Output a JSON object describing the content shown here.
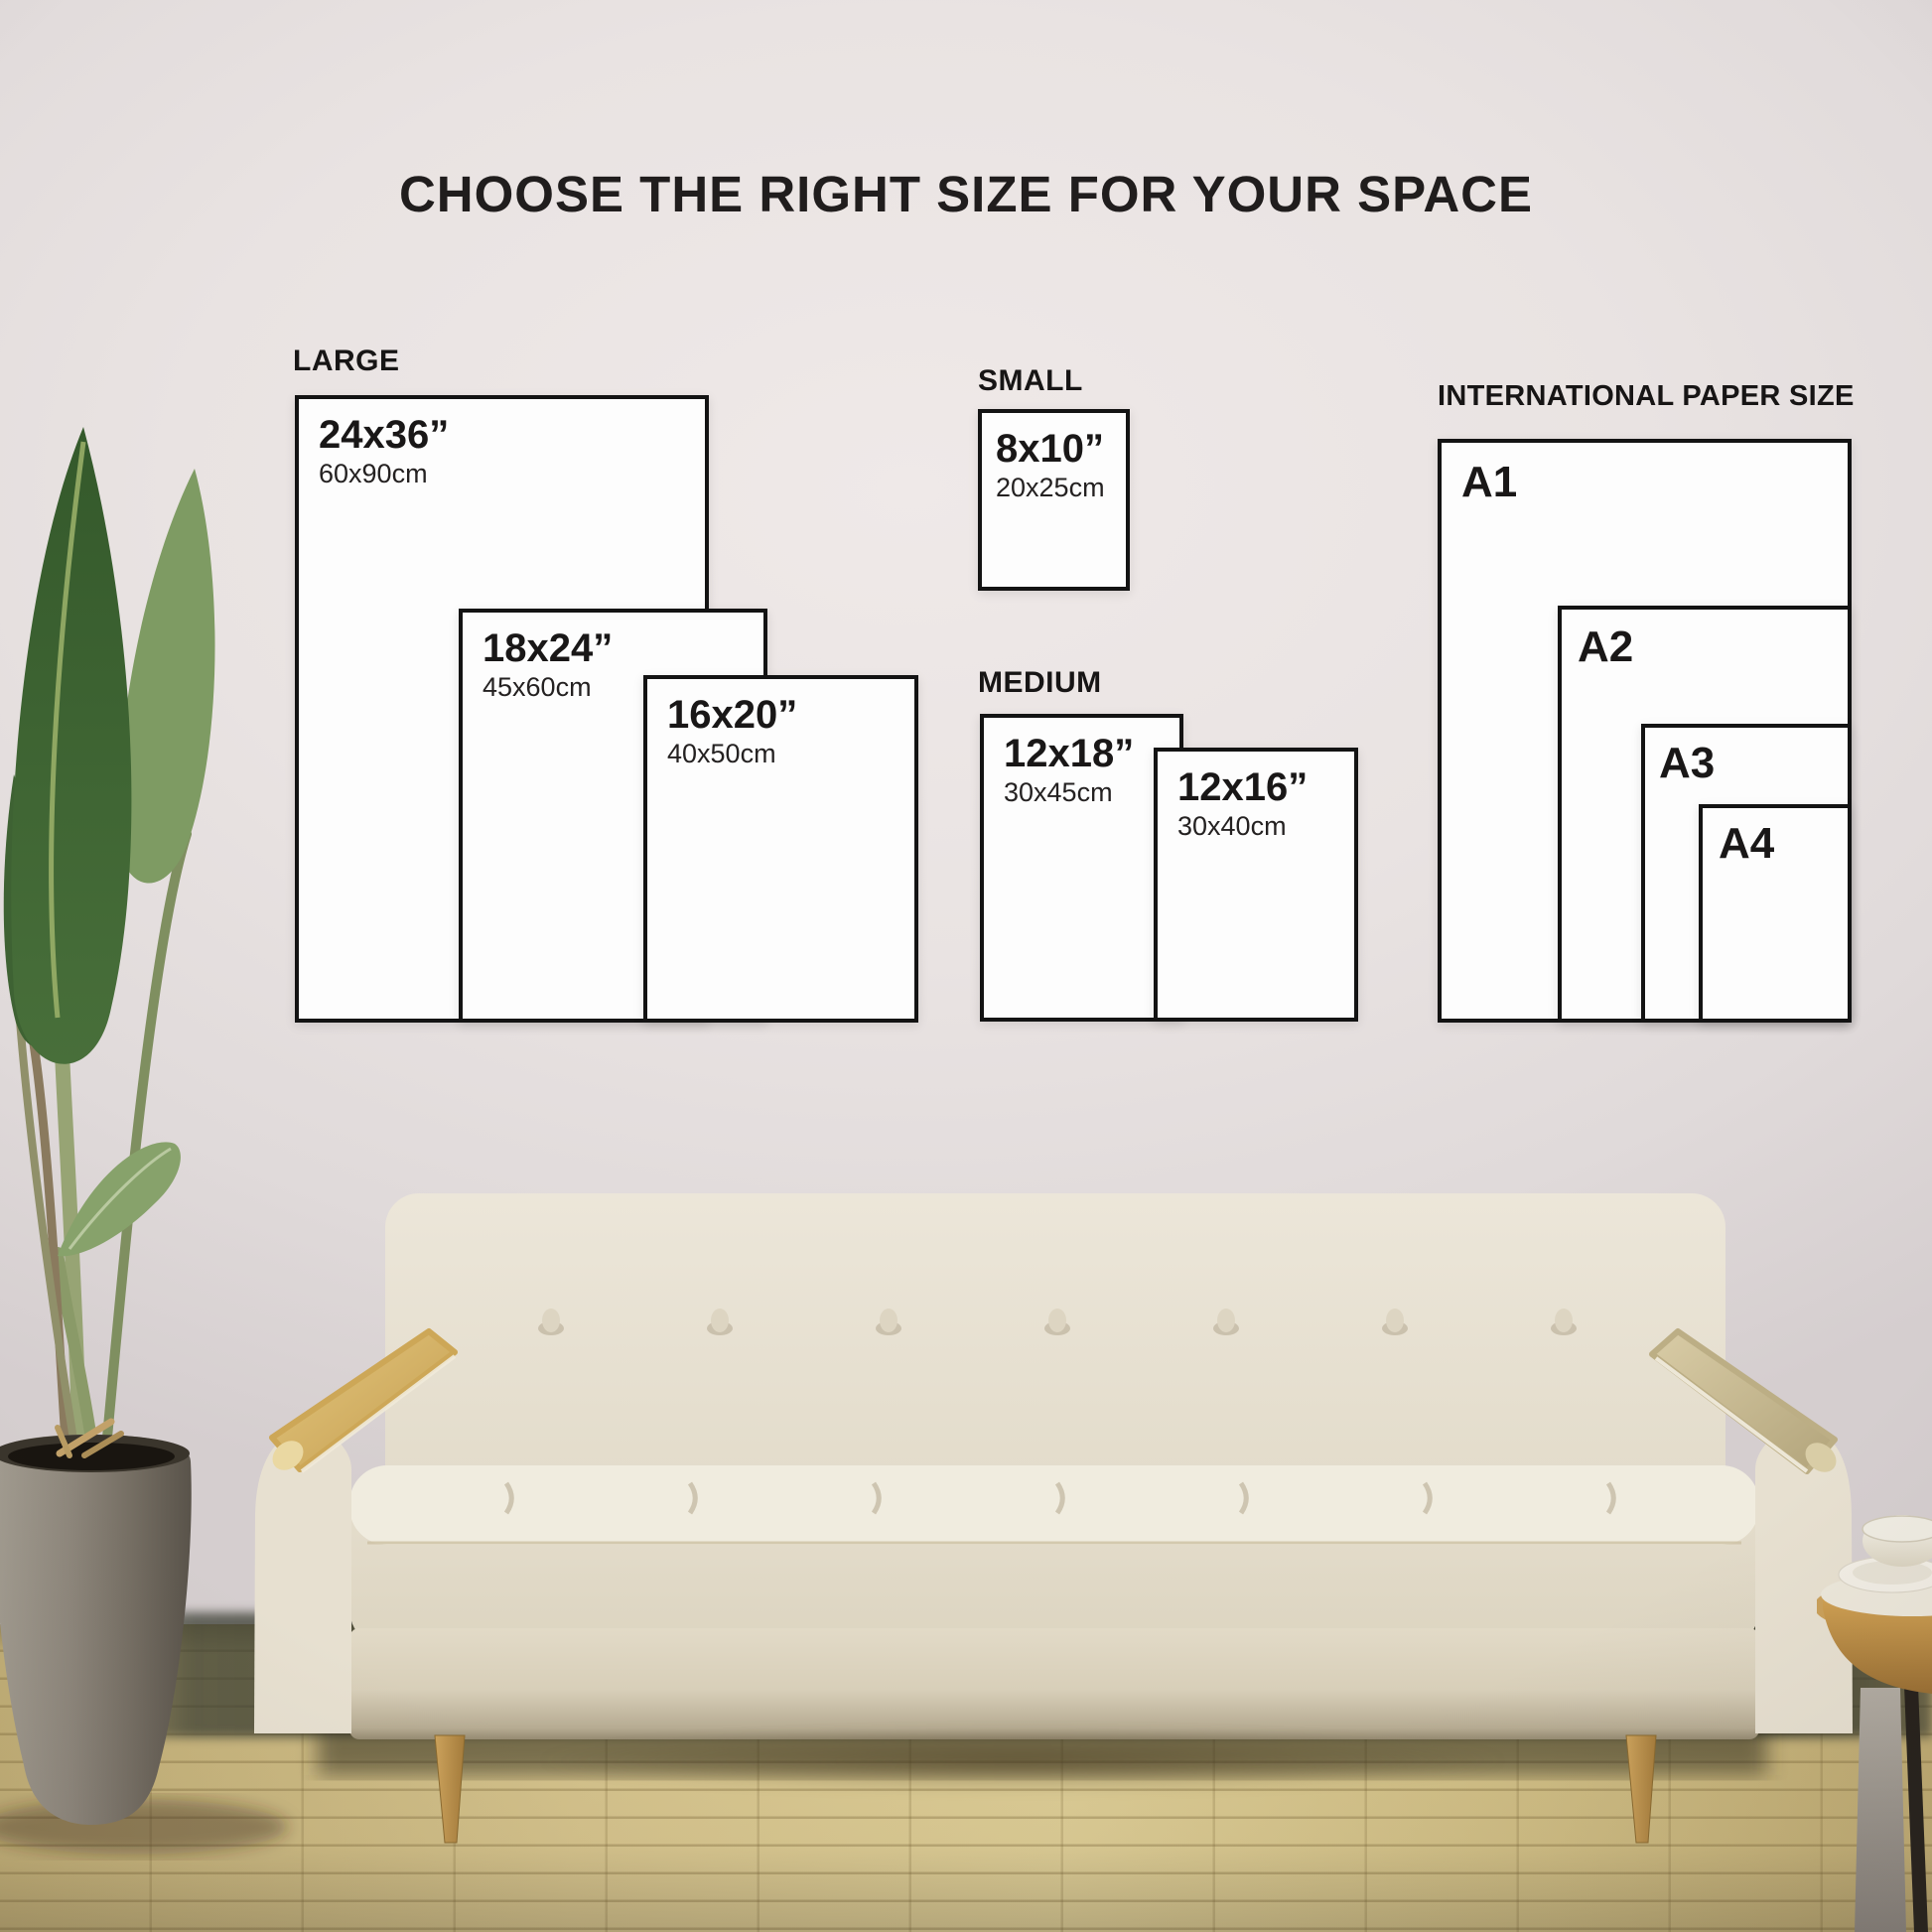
{
  "title": "CHOOSE THE RIGHT SIZE FOR YOUR SPACE",
  "groups": {
    "large": {
      "label": "LARGE",
      "sizes": [
        {
          "inches": "24x36”",
          "cm": "60x90cm"
        },
        {
          "inches": "18x24”",
          "cm": "45x60cm"
        },
        {
          "inches": "16x20”",
          "cm": "40x50cm"
        }
      ]
    },
    "small": {
      "label": "SMALL",
      "sizes": [
        {
          "inches": "8x10”",
          "cm": "20x25cm"
        }
      ]
    },
    "medium": {
      "label": "MEDIUM",
      "sizes": [
        {
          "inches": "12x18”",
          "cm": "30x45cm"
        },
        {
          "inches": "12x16”",
          "cm": "30x40cm"
        }
      ]
    },
    "international": {
      "label": "INTERNATIONAL PAPER SIZE",
      "sizes": [
        {
          "name": "A1"
        },
        {
          "name": "A2"
        },
        {
          "name": "A3"
        },
        {
          "name": "A4"
        }
      ]
    }
  },
  "colors": {
    "text": "#1a1717",
    "box_fill": "#fdfdfd",
    "box_border": "#131313",
    "wall": "#e8e2e2",
    "floor_wood": "#cdbb82",
    "sofa_fabric": "#eae4d6",
    "arm_wood": "#d3b068",
    "leaf_green": "#3f6533",
    "pot_gray": "#87816f"
  }
}
